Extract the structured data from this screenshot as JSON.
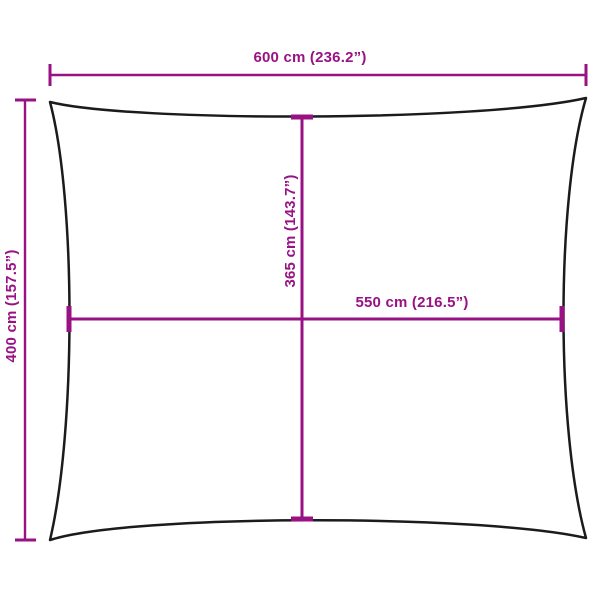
{
  "diagram": {
    "type": "product-dimension-diagram",
    "shape": "rectangular-shade-sail-outline",
    "background": "#ffffff",
    "colors": {
      "dimension_lines": "#991284",
      "shape_outline": "#1b1b1b"
    },
    "dimensions": [
      {
        "id": "overall-width",
        "label": "600 cm (236.2”)",
        "value_cm": 600,
        "value_in": 236.2,
        "orientation": "horizontal",
        "position": "top-outside"
      },
      {
        "id": "overall-height",
        "label": "400 cm (157.5”)",
        "value_cm": 400,
        "value_in": 157.5,
        "orientation": "vertical",
        "position": "left-outside"
      },
      {
        "id": "inner-height",
        "label": "365 cm (143.7”)",
        "value_cm": 365,
        "value_in": 143.7,
        "orientation": "vertical",
        "position": "center"
      },
      {
        "id": "inner-width",
        "label": "550 cm (216.5”)",
        "value_cm": 550,
        "value_in": 216.5,
        "orientation": "horizontal",
        "position": "center"
      }
    ]
  }
}
